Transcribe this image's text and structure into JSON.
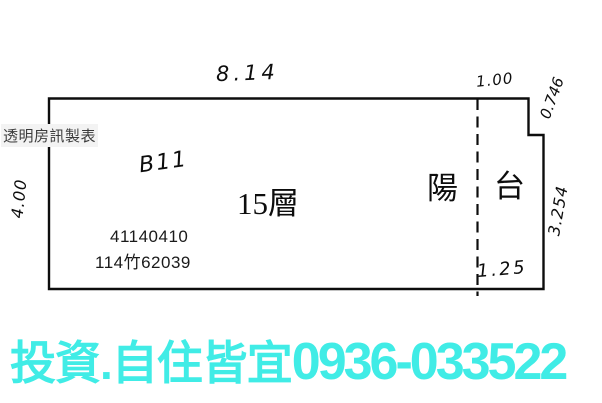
{
  "colors": {
    "accent_cyan": "#40ece6",
    "ink": "#0d0d0d",
    "watermark_bg": "#f3f3f3",
    "watermark_text": "#3b3b3b"
  },
  "watermark": {
    "label": "透明房訊製表"
  },
  "floorplan": {
    "unit_label": "B11",
    "floor_label": "15層",
    "balcony": {
      "char_left": "陽",
      "char_right": "台"
    },
    "registration": {
      "line1": "41140410",
      "line2": "114竹62039"
    },
    "dimensions": {
      "top_width": "8.14",
      "balcony_top_width": "1.00",
      "notch_depth": "0.746",
      "left_depth": "4.00",
      "right_depth": "3.254",
      "balcony_bottom_width": "1.25"
    }
  },
  "footer": {
    "ad_text": "投資.自住皆宜",
    "phone": "0936-033522"
  }
}
